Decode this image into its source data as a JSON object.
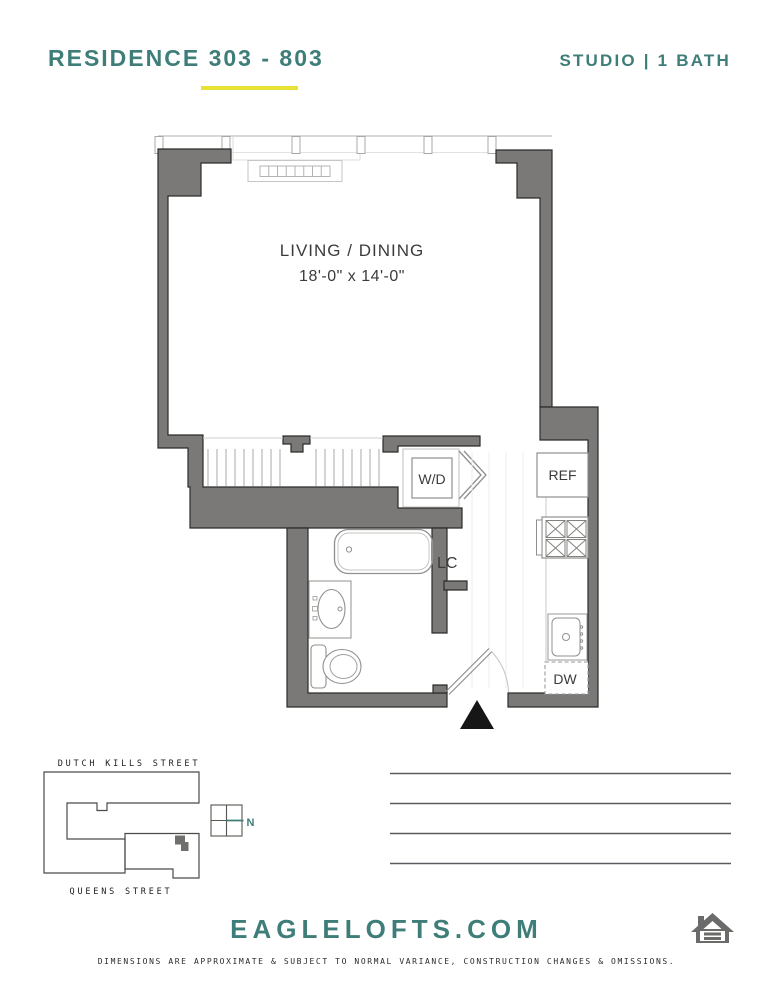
{
  "header": {
    "residence_title": "RESIDENCE 303 - 803",
    "unit_type": "STUDIO | 1 BATH"
  },
  "floor_plan": {
    "living_dining": {
      "label": "LIVING / DINING",
      "dimensions": "18'-0\" x 14'-0\""
    },
    "washer_dryer": "W/D",
    "refrigerator": "REF",
    "linen_closet": "LC",
    "dishwasher": "DW"
  },
  "site_map": {
    "street_top": "DUTCH KILLS STREET",
    "street_bottom": "QUEENS STREET",
    "compass": "N"
  },
  "footer": {
    "website": "EAGLELOFTS.COM",
    "disclaimer": "DIMENSIONS ARE APPROXIMATE & SUBJECT TO NORMAL VARIANCE, CONSTRUCTION CHANGES & OMISSIONS."
  },
  "colors": {
    "accent_teal": "#3E7D78",
    "accent_yellow": "#E6E334",
    "wall_gray": "#7B7977",
    "entry_marker": "#161616"
  }
}
